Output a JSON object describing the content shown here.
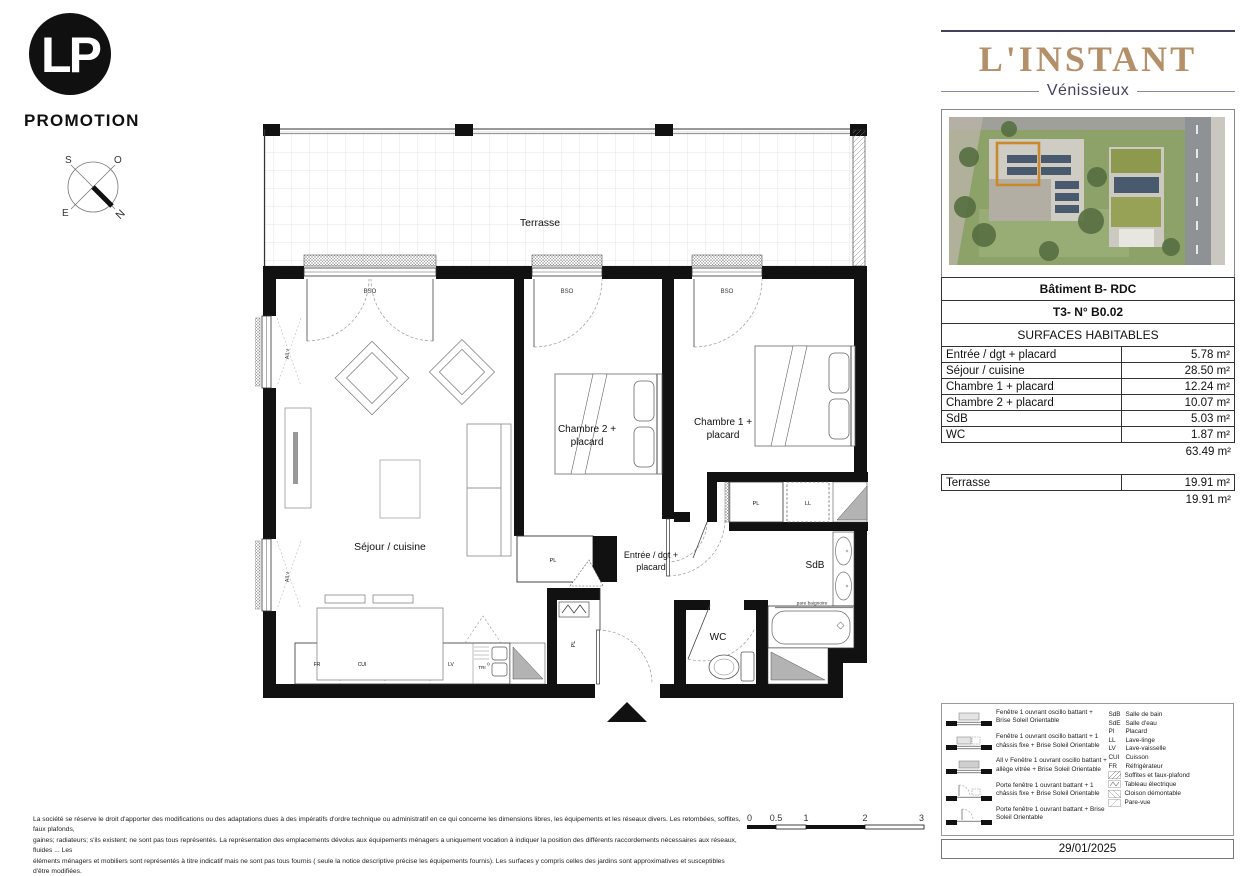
{
  "colors": {
    "brand_gold": "#b4906a",
    "brand_navy": "#454060",
    "highlight_orange": "#c9892e",
    "wall_black": "#111111",
    "soffit_gray": "#b3b3b3"
  },
  "branding": {
    "logo_monogram": "LP",
    "logo_name": "PROMOTION",
    "project": "L'INSTANT",
    "city": "Vénissieux"
  },
  "compass": {
    "n": "N",
    "s": "S",
    "e": "E",
    "o": "O"
  },
  "plan": {
    "terrasse": "Terrasse",
    "bso": "BSO",
    "all_v": "All v",
    "sejour": "Séjour / cuisine",
    "chambre2_line1": "Chambre 2 +",
    "chambre2_line2": "placard",
    "chambre1_line1": "Chambre 1 +",
    "chambre1_line2": "placard",
    "entree_line1": "Entrée / dgt +",
    "entree_line2": "placard",
    "sdb": "SdB",
    "wc": "WC",
    "pl": "PL",
    "ll": "LL",
    "fr": "FR",
    "cui": "CUI",
    "lv": "LV",
    "tri": "TRI",
    "pare_baignoire": "pare baignoire"
  },
  "info": {
    "building": "Bâtiment B- RDC",
    "unit": "T3- N° B0.02",
    "surfaces_title": "SURFACES HABITABLES",
    "surfaces": [
      {
        "label": "Entrée / dgt + placard",
        "value": "5.78 m²"
      },
      {
        "label": "Séjour / cuisine",
        "value": "28.50 m²"
      },
      {
        "label": "Chambre 1 + placard",
        "value": "12.24 m²"
      },
      {
        "label": "Chambre 2 + placard",
        "value": "10.07 m²"
      },
      {
        "label": "SdB",
        "value": "5.03 m²"
      },
      {
        "label": "WC",
        "value": "1.87 m²"
      }
    ],
    "surfaces_total": "63.49 m²",
    "terrace_label": "Terrasse",
    "terrace_value": "19.91 m²",
    "terrace_total": "19.91 m²",
    "date": "29/01/2025"
  },
  "legend": {
    "windows": [
      {
        "text": "Fenêtre 1 ouvrant oscillo battant + Brise Soleil Orientable"
      },
      {
        "text": "Fenêtre 1 ouvrant oscillo battant + 1 châssis fixe + Brise Soleil Orientable"
      },
      {
        "prefix": "All v",
        "text": "Fenêtre 1 ouvrant oscillo battant + allège vitrée + Brise Soleil Orientable"
      },
      {
        "text": "Porte fenêtre 1 ouvrant battant + 1 châssis fixe + Brise Soleil Orientable"
      },
      {
        "text": "Porte fenêtre 1 ouvrant battant + Brise Soleil Orientable"
      }
    ],
    "abbreviations": [
      {
        "abbr": "SdB",
        "label": "Salle de bain"
      },
      {
        "abbr": "SdE",
        "label": "Salle d'eau"
      },
      {
        "abbr": "Pl",
        "label": "Placard"
      },
      {
        "abbr": "LL",
        "label": "Lave-linge"
      },
      {
        "abbr": "LV",
        "label": "Lave-vaisselle"
      },
      {
        "abbr": "CUI",
        "label": "Cuisson"
      },
      {
        "abbr": "FR",
        "label": "Réfrigérateur"
      }
    ],
    "hatches": [
      "Soffites et faux-plafond",
      "Tableau électrique",
      "Cloison démontable",
      "Pare-vue"
    ]
  },
  "scalebar": {
    "ticks": [
      "0",
      "0.5",
      "1",
      "2",
      "3"
    ]
  },
  "disclaimer": {
    "line1": "La société se réserve le droit d'apporter des modifications ou des adaptations dues à des impératifs d'ordre technique ou administratif en ce qui concerne les dimensions libres, les équipements et les réseaux divers. Les retombées, soffites, faux plafonds,",
    "line2": "gaines; radiateurs; s'ils existent; ne sont pas tous représentés. La représentation des emplacements dévolus aux équipements ménagers a uniquement vocation à indiquer la position des différents raccordements nécessaires aux réseaux, fluides ... Les",
    "line3": "éléments ménagers et mobiliers sont représentés à titre indicatif mais ne sont pas tous fournis ( seule la notice descriptive précise les équipements fournis). Les surfaces y compris celles des jardins sont approximatives et susceptibles d'être modifiées."
  }
}
